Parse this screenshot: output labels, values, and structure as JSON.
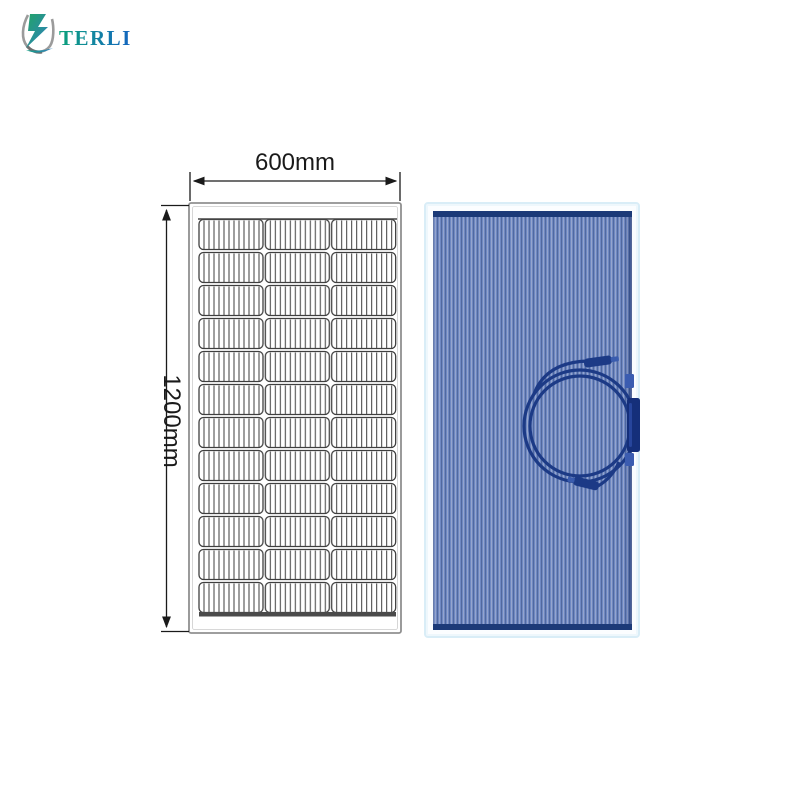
{
  "brand": {
    "name": "TERLI",
    "logo": {
      "icon": "lightning-cup-icon",
      "text_gradient_start": "#0aa179",
      "text_gradient_end": "#1464c0"
    }
  },
  "drawing": {
    "width_label": "600mm",
    "height_label": "1200mm",
    "panel_grid": {
      "columns": 3,
      "rows": 12,
      "total_cells": 36
    },
    "line_color": "#3f3f3f",
    "frame_color": "#909090"
  },
  "photo": {
    "panel_border_color": "#d9edf7",
    "cell_stripe_colors": [
      "#51699f",
      "#6f88c2",
      "#95a5cd"
    ],
    "edge_strip_color": "#1c3a78",
    "cable_color": "#1c3a86",
    "junction_box_color": "#152f7a",
    "features": [
      "coiled-cable-with-mc4-connectors",
      "side-junction-box"
    ]
  }
}
